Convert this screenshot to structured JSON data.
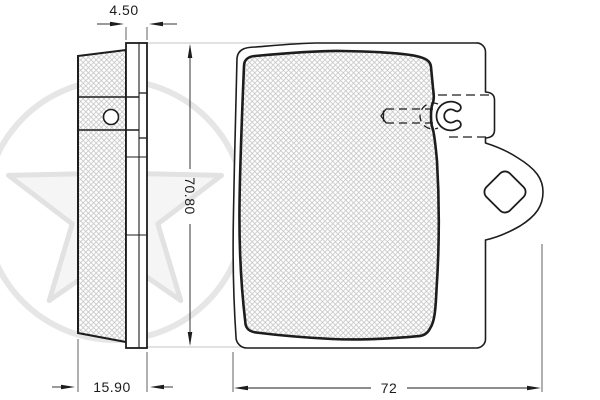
{
  "drawing": {
    "subject": "brake-pad-technical-drawing",
    "views": {
      "side_view": "left profile with friction material and back plate",
      "front_view": "pad face with retention slot and ear tab"
    },
    "dimensions": {
      "back_plate_thickness": "4.50",
      "total_thickness": "15.90",
      "pad_height": "70.80",
      "pad_width": "72"
    },
    "watermark": "optimal-star-logo",
    "colors": {
      "line": "#1d1d1d",
      "background": "#ffffff",
      "hatch": "#c6c6c6",
      "watermark": "#e4e4e4"
    }
  }
}
